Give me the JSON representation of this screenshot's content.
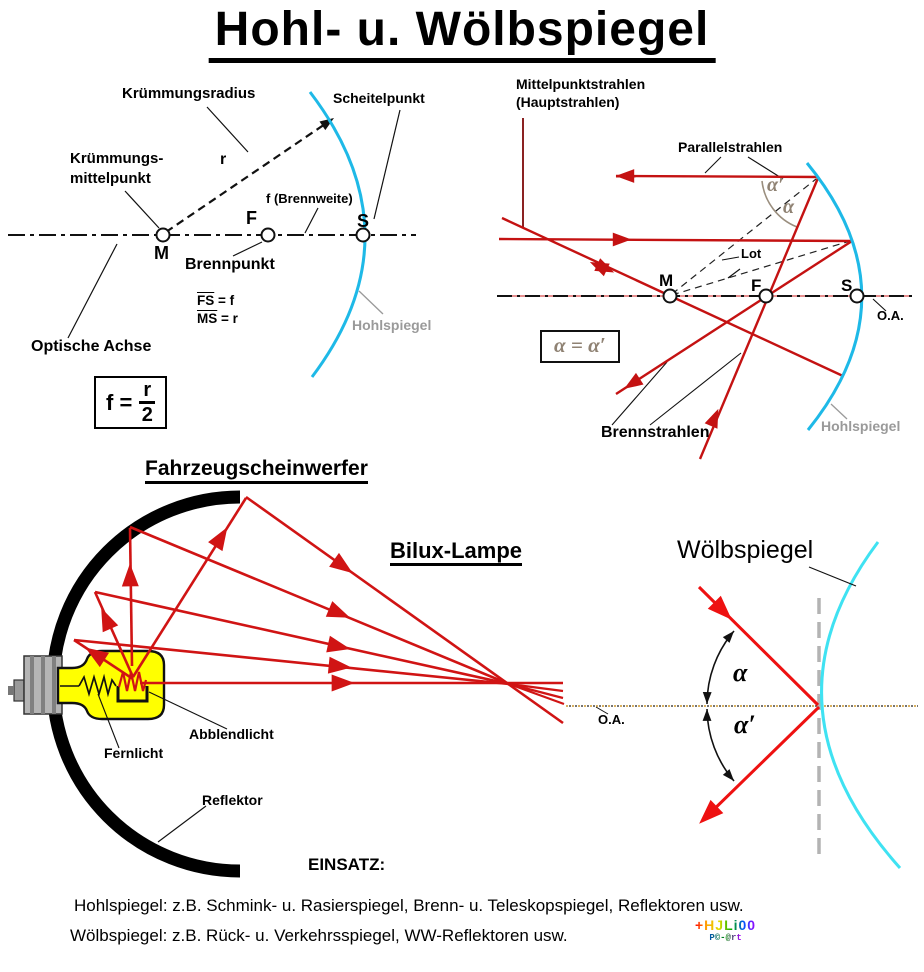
{
  "title": "Hohl- u. Wölbspiegel",
  "colors": {
    "ray_red": "#D01414",
    "crimson": "#C41212",
    "convex_ray_red": "#EE1111",
    "mirror_cyan": "#1EB9E7",
    "convex_cyan": "#3FE2F2",
    "maroon": "#8B2222",
    "gray_label": "#9A9A9A",
    "bulb_yellow": "#FFFF00"
  },
  "concave": {
    "kruemmungsradius": "Krümmungsradius",
    "scheitelpunkt": "Scheitelpunkt",
    "kruemmungs1": "Krümmungs-",
    "kruemmungs2": "mittelpunkt",
    "r": "r",
    "f_brennweite": "f (Brennweite)",
    "F": "F",
    "S": "S",
    "M": "M",
    "brennpunkt": "Brennpunkt",
    "fs_bar": "FS",
    "fs_eq": " = f",
    "ms_bar": "MS",
    "ms_eq": " = r",
    "hohlspiegel": "Hohlspiegel",
    "optische_achse": "Optische Achse",
    "formula_lhs": "f =",
    "formula_num": "r",
    "formula_den": "2"
  },
  "rays": {
    "mittelpunktstrahlen": "Mittelpunktstrahlen",
    "hauptstrahlen": "(Hauptstrahlen)",
    "parallelstrahlen": "Parallelstrahlen",
    "alpha_prime": "α′",
    "alpha": "α",
    "lot": "Lot",
    "M": "M",
    "F": "F",
    "S": "S",
    "oa": "O.A.",
    "alpha_eq": "α = α′",
    "brennstrahlen": "Brennstrahlen",
    "hohlspiegel": "Hohlspiegel"
  },
  "headlight": {
    "title": "Fahrzeugscheinwerfer",
    "lamp": "Bilux-Lampe",
    "abblendlicht": "Abblendlicht",
    "fernlicht": "Fernlicht",
    "reflektor": "Reflektor",
    "oa": "O.A."
  },
  "convex": {
    "title": "Wölbspiegel",
    "alpha": "α",
    "alpha_prime": "α′"
  },
  "footer": {
    "einsatz": "EINSATZ:",
    "line1": "Hohlspiegel: z.B. Schmink- u. Rasierspiegel, Brenn- u. Teleskopspiegel, Reflektoren usw.",
    "line2": "Wölbspiegel: z.B. Rück- u. Verkehrsspiegel, WW-Reflektoren usw.",
    "logo1": "+HJLi00",
    "logo2": "P©-@rt"
  }
}
